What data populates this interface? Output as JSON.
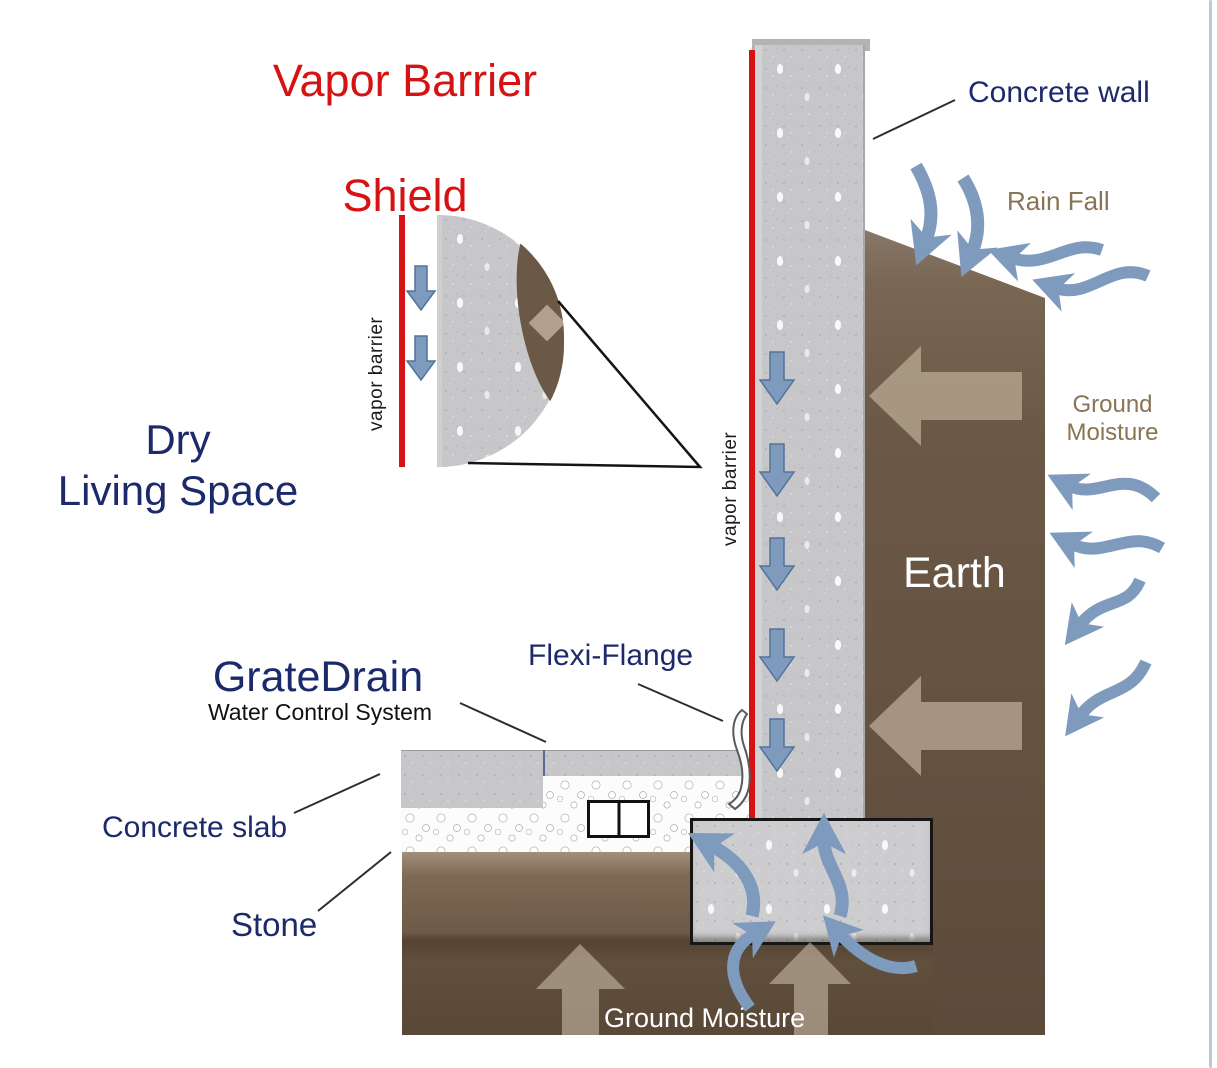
{
  "title": {
    "line1": "Vapor Barrier",
    "line2": "Shield"
  },
  "labels": {
    "dry_living_space": "Dry\nLiving Space",
    "concrete_wall": "Concrete wall",
    "rain_fall": "Rain Fall",
    "ground_moisture_side": "Ground\nMoisture",
    "earth": "Earth",
    "grate_drain": "GrateDrain",
    "water_control_system": "Water Control System",
    "flexi_flange": "Flexi-Flange",
    "concrete_slab": "Concrete slab",
    "stone": "Stone",
    "ground_moisture_bottom": "Ground Moisture",
    "vapor_barrier_detail": "vapor barrier",
    "vapor_barrier_wall": "vapor barrier"
  },
  "arrows": {
    "rain_fall": "curved blue arrows falling onto the ground surface",
    "ground_moisture_side": "wavy blue arrows pressing into the earth from the right",
    "earth_pressure": "large tan arrows pushing left toward the concrete wall",
    "ground_moisture_up": "tan arrows rising from the soil below",
    "wall_seepage": "blue arrows moving down the wall behind the vapor barrier",
    "footing_wicking": "blue arrows curling up through the footing"
  },
  "colors": {
    "accent_red": "#d61212",
    "navy": "#1c2a6b",
    "brown_text": "#8b7355",
    "arrow_blue": "#7e9abc",
    "earth_brown": "#6b5846",
    "tan_arrow": "#b5a690",
    "concrete_gray": "#c7c7ca",
    "frame_blue": "#b9cadb"
  }
}
